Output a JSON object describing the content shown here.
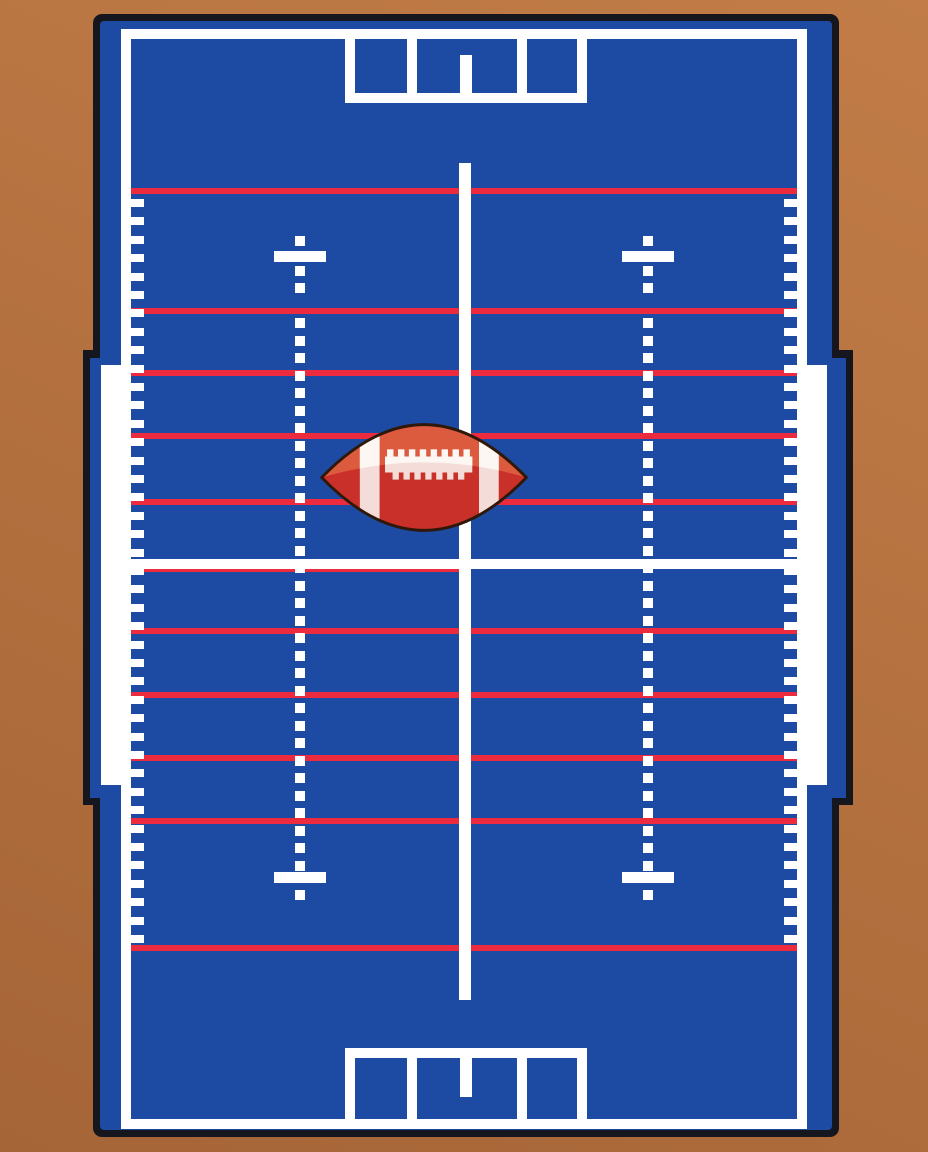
{
  "canvas": {
    "width": 928,
    "height": 1152
  },
  "colors": {
    "background_light": "#c17c47",
    "background_dark": "#a66537",
    "outline_navy": "#16161e",
    "field_blue": "#1d4aa3",
    "line_white": "#ffffff",
    "line_red": "#ed2b3e",
    "ball_red": "#c93029",
    "ball_orange": "#dc5a3e",
    "ball_stripe_pink": "#f4ddd8",
    "ball_stripe_white": "#fdf7f3",
    "ball_outline": "#301809"
  },
  "field": {
    "yard_lines": {
      "x": 131,
      "width": 666,
      "height": 6,
      "y": [
        188,
        308,
        370,
        433,
        499,
        628,
        692,
        755,
        818,
        945
      ]
    },
    "midfield": {
      "x": 131,
      "y": 559,
      "w": 666,
      "h": 10,
      "red_x": 131,
      "red_y": 566,
      "red_w": 330,
      "red_h": 6
    },
    "ticks": {
      "sides": [
        131,
        784
      ],
      "start": 199,
      "step": 18.4,
      "count": 41,
      "w": 13,
      "h": 8
    },
    "hash_columns": [
      300,
      648
    ],
    "dot_size": 10,
    "hash_dot_y": [
      236,
      266,
      283,
      318,
      336,
      353,
      371,
      388,
      406,
      423,
      441,
      458,
      476,
      493,
      511,
      528,
      546,
      563,
      581,
      598,
      616,
      633,
      651,
      668,
      686,
      703,
      721,
      738,
      756,
      773,
      791,
      808,
      826,
      843,
      861,
      890
    ],
    "hash_bars": [
      {
        "x": 274,
        "y": 251
      },
      {
        "x": 622,
        "y": 251
      },
      {
        "x": 274,
        "y": 872
      },
      {
        "x": 622,
        "y": 872
      }
    ],
    "hash_bar_w": 52,
    "hash_bar_h": 11,
    "goals": [
      {
        "verts": [
          345,
          407,
          517,
          577
        ],
        "vy": 39,
        "vh": 64,
        "vw": 10,
        "bar": {
          "x": 345,
          "y": 93,
          "w": 242,
          "h": 10
        },
        "stub": {
          "x": 460,
          "y": 55,
          "w": 12,
          "h": 38
        }
      },
      {
        "verts": [
          345,
          407,
          517,
          577
        ],
        "vy": 1048,
        "vh": 71,
        "vw": 10,
        "bar": {
          "x": 345,
          "y": 1048,
          "w": 242,
          "h": 10
        },
        "stub": {
          "x": 460,
          "y": 1058,
          "w": 12,
          "h": 39
        }
      }
    ]
  }
}
